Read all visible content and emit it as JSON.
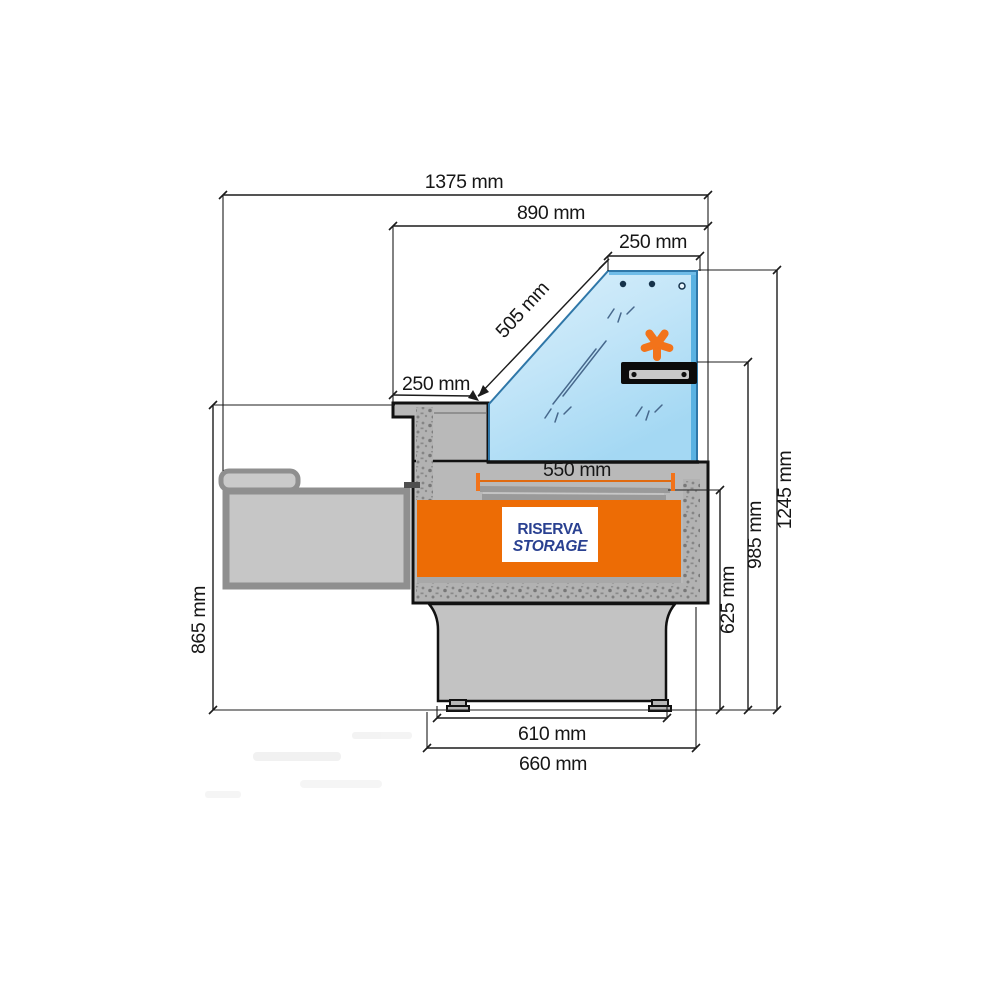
{
  "diagram": {
    "title": "refrigerated-counter-cross-section",
    "dims": {
      "total_width": "1375 mm",
      "upper_width": "890 mm",
      "glass_top_width": "250 mm",
      "glass_slope_length": "505 mm",
      "rear_counter_depth": "250 mm",
      "deck_width": "550 mm",
      "counter_height": "865 mm",
      "shelf_height": "625 mm",
      "light_height": "985 mm",
      "total_height": "1245 mm",
      "feet_spacing": "610 mm",
      "base_width": "660 mm"
    },
    "storage_label": {
      "line1": "RISERVA",
      "line2": "STORAGE"
    },
    "icons": {
      "asterisk": "asterisk-icon",
      "light_bar": "light-bar"
    },
    "colors": {
      "storage_orange": "#ed6c05",
      "asterisk_orange": "#f2731a",
      "glass_blue": "#b9e0f6",
      "glass_edge_blue": "#5ab2e2",
      "label_navy": "#2a4191",
      "cabinet_gray": "#b9b9b9",
      "outline_black": "#111111"
    }
  }
}
